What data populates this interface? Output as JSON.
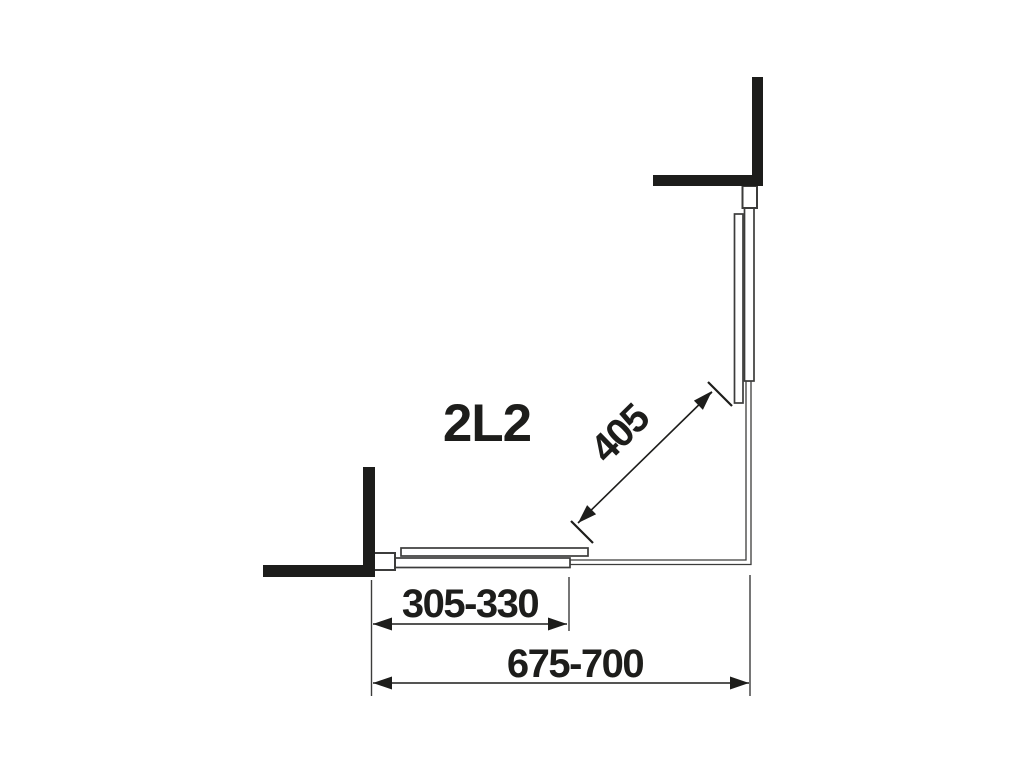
{
  "diagram": {
    "model_label": "2L2",
    "dimensions": {
      "diagonal": {
        "value": "405"
      },
      "segment_width": {
        "value": "305-330"
      },
      "overall_width": {
        "value": "675-700"
      }
    },
    "colors": {
      "wall": "#1d1d1b",
      "line": "#3c3c3b",
      "text": "#1d1d1b",
      "background": "#ffffff"
    }
  }
}
